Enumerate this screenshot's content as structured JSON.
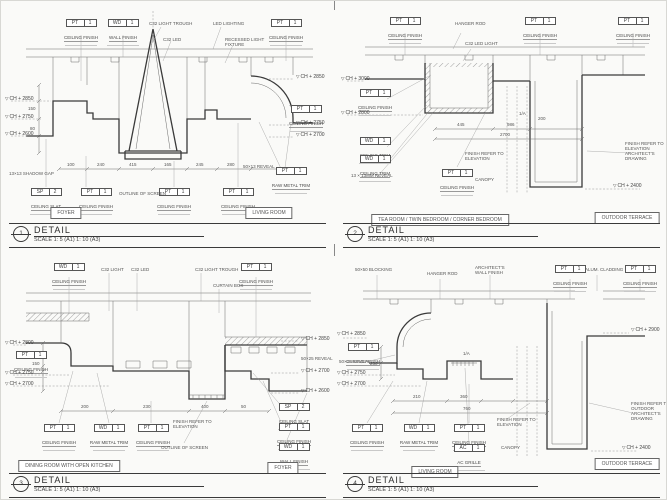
{
  "page": {
    "level_symbol": "▽"
  },
  "title_block": {
    "title": "DETAIL",
    "scale": "SCALE 1: 5 (A1)   1: 10 (A3)"
  },
  "panels": [
    {
      "number": "1",
      "rooms": {
        "left": "FOYER",
        "right": "LIVING ROOM"
      },
      "tags": [
        {
          "code": "PT",
          "num": "1",
          "label": "CEILING FINISH"
        },
        {
          "code": "WD",
          "num": "1",
          "label": "WALL FINISH"
        },
        {
          "code": "PT",
          "num": "1",
          "label": "CEILING FINISH"
        },
        {
          "code": "PT",
          "num": "1",
          "label": "CEILING FINISH"
        },
        {
          "code": "SP",
          "num": "2",
          "label": "CEILING SLAT"
        },
        {
          "code": "PT",
          "num": "1",
          "label": "CEILING FINISH"
        },
        {
          "code": "PT",
          "num": "1",
          "label": "CEILING FINISH"
        },
        {
          "code": "PT",
          "num": "1",
          "label": "CEILING FINISH"
        },
        {
          "code": "PT",
          "num": "1",
          "label": "RAW METAL TRIM"
        }
      ],
      "levels": [
        "CH + 2850",
        "CH + 2750",
        "CH + 2600",
        "CH + 2850",
        "CH + 2750",
        "CH + 2700"
      ],
      "notes": [
        "C32 LIGHT TROUGH",
        "C32 LED",
        "LED LIGHTING",
        "RECESSED LIGHT FIXTURE",
        "OUTLINE OF SCREEN",
        "13×13 SHADOW GAP",
        "50×13 REVEAL"
      ],
      "dims": [
        "100",
        "240",
        "415",
        "165",
        "245",
        "280",
        "150",
        "80"
      ]
    },
    {
      "number": "2",
      "rooms": {
        "left": "TEA ROOM / TWIN BEDROOM / CORNER BEDROOM",
        "right": "OUTDOOR TERRACE"
      },
      "tags": [
        {
          "code": "PT",
          "num": "1",
          "label": "CEILING FINISH"
        },
        {
          "code": "PT",
          "num": "1",
          "label": "CEILING FINISH"
        },
        {
          "code": "PT",
          "num": "1",
          "label": "CEILING FINISH"
        },
        {
          "code": "PT",
          "num": "1",
          "label": "CEILING FINISH"
        },
        {
          "code": "WD",
          "num": "1",
          "label": "CEILING TRIM"
        },
        {
          "code": "WD",
          "num": "1",
          "label": "CEILING TRIM"
        },
        {
          "code": "PT",
          "num": "1",
          "label": "CEILING FINISH"
        }
      ],
      "levels": [
        "CH + 3000",
        "CH + 2800",
        "CH + 2400"
      ],
      "notes": [
        "HANGER ROD",
        "C32 LED LIGHT",
        "13 × 13MM REVEAL",
        "FINISH REFER TO ELEVATION",
        "CANOPY",
        "FINISH REFER TO ELEVATION ARCHITECT'S DRAWING",
        "1/A"
      ],
      "dims": [
        "445",
        "986",
        "2700",
        "200"
      ]
    },
    {
      "number": "3",
      "rooms": {
        "left": "DINING ROOM WITH OPEN KITCHEN",
        "right": "FOYER"
      },
      "tags": [
        {
          "code": "WD",
          "num": "1",
          "label": "CEILING FINISH"
        },
        {
          "code": "PT",
          "num": "1",
          "label": "CEILING FINISH"
        },
        {
          "code": "PT",
          "num": "1",
          "label": "CEILING FINISH"
        },
        {
          "code": "SP",
          "num": "2",
          "label": "CEILING SLAT"
        },
        {
          "code": "PT",
          "num": "1",
          "label": "CEILING FINISH"
        },
        {
          "code": "WD",
          "num": "1",
          "label": "WALL FINISH"
        },
        {
          "code": "PT",
          "num": "1",
          "label": "CEILING FINISH"
        },
        {
          "code": "WD",
          "num": "1",
          "label": "RAW METAL TRIM"
        },
        {
          "code": "PT",
          "num": "1",
          "label": "CEILING FINISH"
        }
      ],
      "levels": [
        "CH + 2800",
        "CH + 2750",
        "CH + 2700",
        "CH + 2850",
        "CH + 2700",
        "CH + 2600"
      ],
      "notes": [
        "C32 LIGHT",
        "C32 LED",
        "C32 LIGHT TROUGH",
        "CURTAIN BOX",
        "FINISH REFER TO ELEVATION",
        "OUTLINE OF SCREEN",
        "50×25 REVEAL"
      ],
      "dims": [
        "200",
        "230",
        "400",
        "50",
        "150"
      ]
    },
    {
      "number": "4",
      "rooms": {
        "left": "LIVING ROOM",
        "right": "OUTDOOR TERRACE"
      },
      "tags": [
        {
          "code": "PT",
          "num": "1",
          "label": "CEILING FINISH"
        },
        {
          "code": "PT",
          "num": "1",
          "label": "CEILING FINISH"
        },
        {
          "code": "PT",
          "num": "1",
          "label": "CEILING FINISH"
        },
        {
          "code": "PT",
          "num": "1",
          "label": "CEILING FINISH"
        },
        {
          "code": "WD",
          "num": "1",
          "label": "RAW METAL TRIM"
        },
        {
          "code": "PT",
          "num": "1",
          "label": "CEILING FINISH"
        },
        {
          "code": "AC",
          "num": "1",
          "label": "AC GRILLE"
        }
      ],
      "levels": [
        "CH + 2850",
        "CH + 2750",
        "CH + 2700",
        "CH + 2900",
        "CH + 2400"
      ],
      "notes": [
        "50×50 BLOCKING",
        "HANGER ROD",
        "ARCHITECT'S WALL FINISH",
        "ALUM. CLADDING",
        "FINISH REFER TO ELEVATION",
        "CANOPY",
        "FINISH REFER TO OUTDOOR ARCHITECT'S DRAWING",
        "1/A",
        "50×25 REVEAL"
      ],
      "dims": [
        "210",
        "360",
        "760",
        "250"
      ]
    }
  ]
}
